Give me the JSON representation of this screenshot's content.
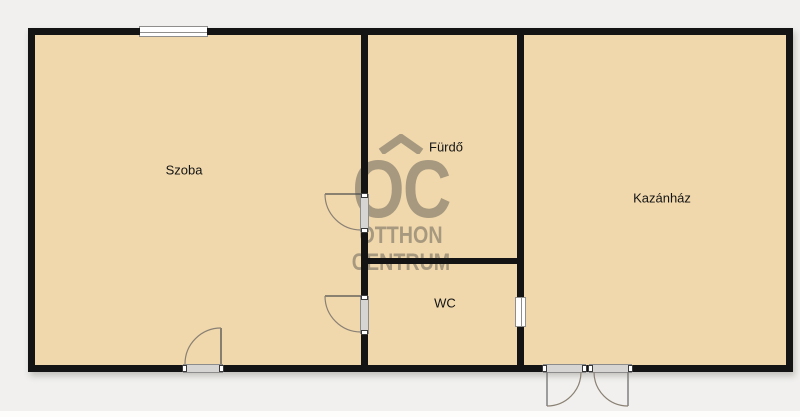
{
  "plan": {
    "title": "floor-plan",
    "colors": {
      "floor": "#f0d8ac",
      "wall": "#141414",
      "background": "#f1f0ee",
      "watermark": "#6c665b",
      "door_frame": "#d6d5d3"
    }
  },
  "rooms": {
    "szoba": {
      "label": "Szoba"
    },
    "furdo": {
      "label": "Fürdő"
    },
    "wc": {
      "label": "WC"
    },
    "kazanhaz": {
      "label": "Kazánház"
    }
  },
  "watermark": {
    "monogram": "OC",
    "line1": "OTTHON",
    "line2": "CENTRUM"
  }
}
